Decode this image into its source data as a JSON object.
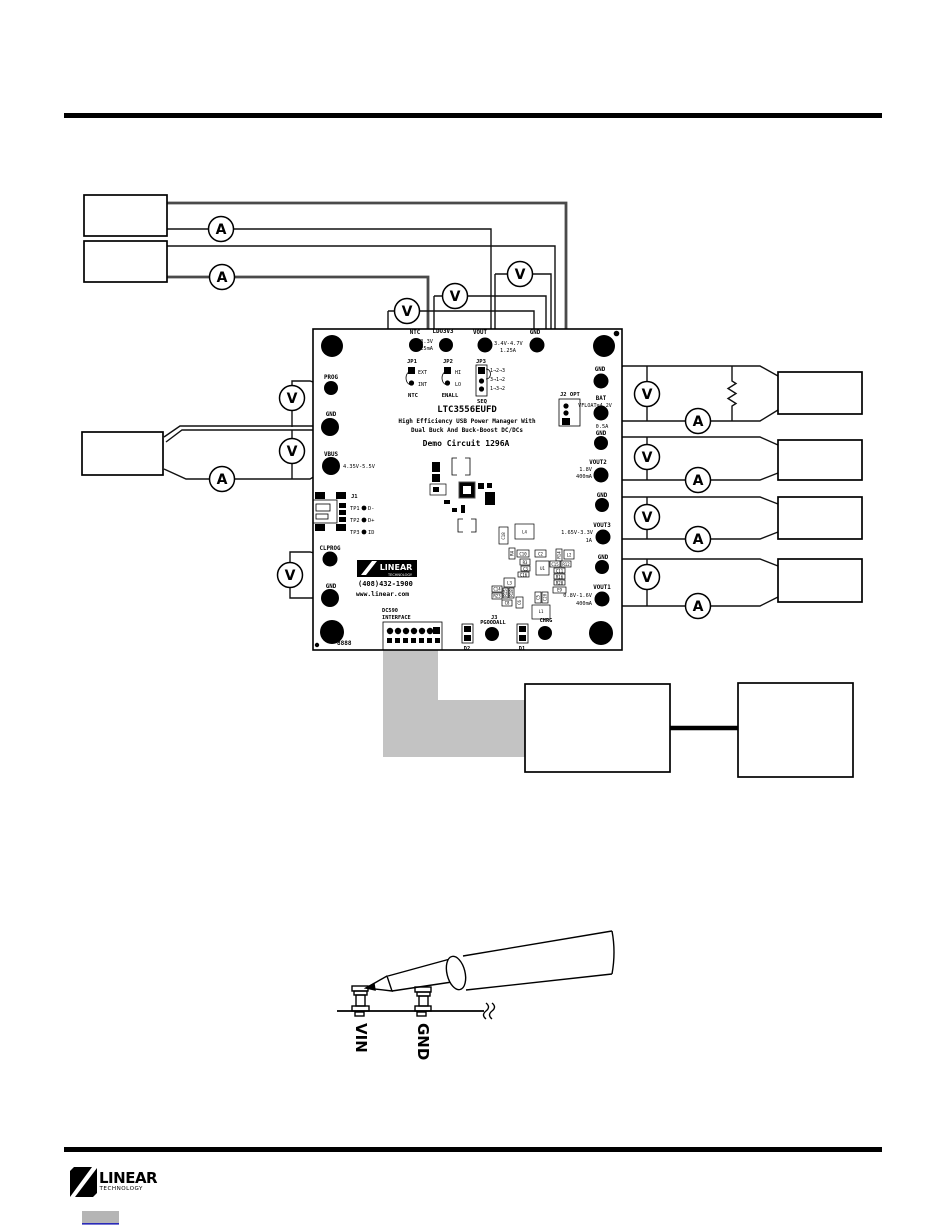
{
  "doc": {
    "meters": {
      "volt": "V",
      "amp": "A"
    },
    "board": {
      "part_number": "LTC3556EUFD",
      "desc_line1": "High Efficiency USB Power Manager With",
      "desc_line2": "Dual Buck And Buck-Boost DC/DCs",
      "desc_line3": "Demo Circuit 1296A",
      "vendor_phone": "(408)432-1900",
      "vendor_web": "www.linear.com",
      "vendor_logo_line1": "LINEAR",
      "vendor_logo_line2": "TECHNOLOGY",
      "serial": "8888",
      "top_pads": {
        "ntc": "NTC",
        "ldo3v3": "LDO3V3",
        "ldo3v3_v": "3.3V",
        "ldo3v3_i": "25mA",
        "vout": "VOUT",
        "vout_v": "3.4V-4.7V",
        "vout_i": "1.25A",
        "gnd": "GND"
      },
      "left_pads": {
        "prog": "PROG",
        "gnd1": "GND",
        "vbus": "VBUS",
        "vbus_range": "4.35V-5.5V",
        "clprog": "CLPROG",
        "gnd2": "GND"
      },
      "right_pads": {
        "gnd1": "GND",
        "bat": "BAT",
        "bat_float": "VFLOAT=4.2V",
        "bat_i": "0.5A",
        "gnd2": "GND",
        "vout2": "VOUT2",
        "vout2_v": "1.8V",
        "vout2_i": "400mA",
        "gnd3": "GND",
        "vout3": "VOUT3",
        "vout3_v": "1.65V-3.3V",
        "vout3_i": "1A",
        "gnd4": "GND",
        "vout1": "VOUT1",
        "vout1_v": "0.8V-1.6V",
        "vout1_i": "400mA"
      },
      "jumpers": {
        "jp1": {
          "name": "JP1",
          "opt1": "EXT",
          "opt2": "INT",
          "label": "NTC"
        },
        "jp2": {
          "name": "JP2",
          "opt1": "HI",
          "opt2": "LO",
          "label": "ENALL"
        },
        "jp3": {
          "name": "JP3",
          "opt1": "1→2→3",
          "opt2": "3→1→2",
          "opt3": "1→3→2",
          "label": "SEQ"
        }
      },
      "connectors": {
        "j1": {
          "name": "J1",
          "tp1": "TP1",
          "tp1_sig": "D-",
          "tp2": "TP2",
          "tp2_sig": "D+",
          "tp3": "TP3",
          "tp3_sig": "ID"
        },
        "j2": {
          "label": "J2 OPT"
        },
        "j3": {
          "name": "J3",
          "label1": "DC590",
          "label2": "INTERFACE"
        }
      },
      "bottom_edge": {
        "d2": "D2",
        "pgoodall": "PGOODALL",
        "d1": "D1",
        "chrg": "CHRG"
      },
      "components": [
        "C18",
        "L4",
        "R4",
        "C10",
        "R3",
        "C3",
        "C16",
        "C2",
        "R14",
        "L2",
        "C15",
        "R12",
        "C11",
        "R16",
        "R20",
        "U1",
        "E9",
        "L3",
        "C14",
        "R23",
        "R15",
        "R18",
        "C8",
        "C6",
        "C5",
        "C20",
        "L1"
      ]
    },
    "probe": {
      "vin": "VIN",
      "gnd": "GND"
    },
    "footer": {
      "logo_line1": "LINEAR",
      "logo_line2": "TECHNOLOGY"
    }
  }
}
